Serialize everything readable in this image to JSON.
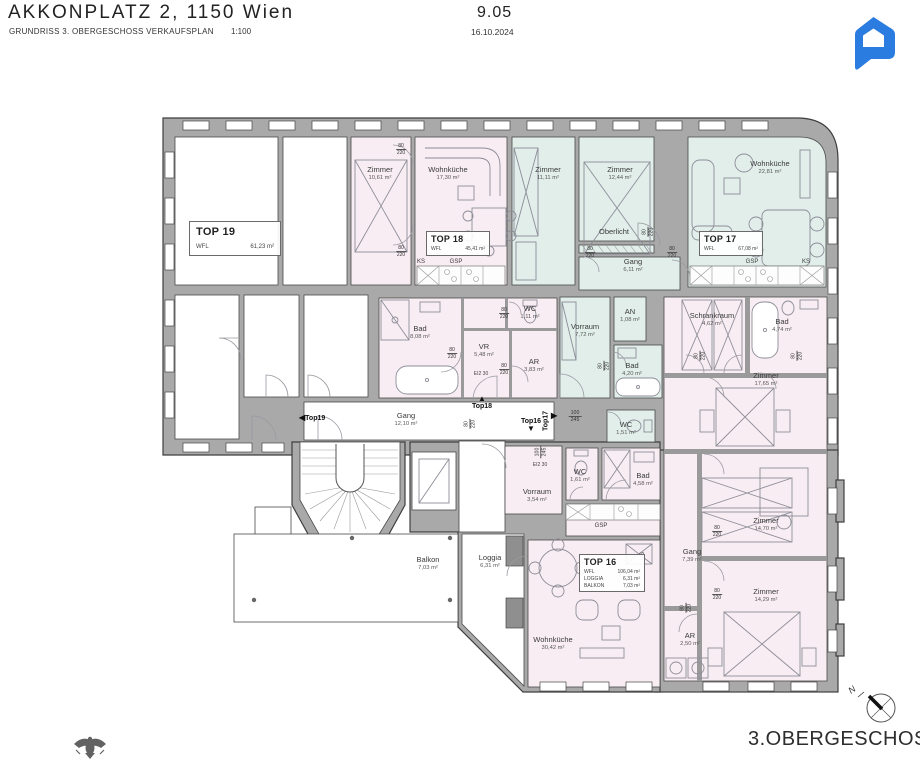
{
  "header": {
    "title": "AKKONPLATZ 2, 1150 Wien",
    "subtitle": "GRUNDRISS 3. OBERGESCHOSS VERKAUFSPLAN",
    "scale": "1:100",
    "sheet_number": "9.05",
    "date": "16.10.2024"
  },
  "colors": {
    "unit_pink": "#f8edf2",
    "unit_teal": "#e1eeea",
    "wall_gray": "#a9a9a9",
    "logo_blue": "#2b7ce0"
  },
  "units": {
    "top19": {
      "name": "TOP 19",
      "wfl_label": "WFL",
      "area": "61,23 m²"
    },
    "top18": {
      "name": "TOP 18",
      "wfl_label": "WFL",
      "area": "45,41 m²"
    },
    "top17": {
      "name": "TOP 17",
      "wfl_label": "WFL",
      "area": "67,08 m²"
    },
    "top16": {
      "name": "TOP 16",
      "rows": [
        {
          "label": "WFL",
          "value": "106,04 m²"
        },
        {
          "label": "LOGGIA",
          "value": "6,31 m²"
        },
        {
          "label": "BALKON",
          "value": "7,03 m²"
        }
      ]
    }
  },
  "rooms": [
    {
      "name": "Zimmer",
      "area": "10,61 m²"
    },
    {
      "name": "Wohnküche",
      "area": "17,30 m²"
    },
    {
      "name": "Zimmer",
      "area": "11,11 m²"
    },
    {
      "name": "Zimmer",
      "area": "12,44 m²"
    },
    {
      "name": "Wohnküche",
      "area": "22,81 m²"
    },
    {
      "name": "Oberlicht",
      "area": ""
    },
    {
      "name": "Gang",
      "area": "6,11 m²"
    },
    {
      "name": "Bad",
      "area": "8,08 m²"
    },
    {
      "name": "WC",
      "area": "1,11 m²"
    },
    {
      "name": "VR",
      "area": "5,48 m²"
    },
    {
      "name": "AR",
      "area": "3,83 m²"
    },
    {
      "name": "Vorraum",
      "area": "7,72 m²"
    },
    {
      "name": "AN",
      "area": "1,08 m²"
    },
    {
      "name": "Bad",
      "area": "4,20 m²"
    },
    {
      "name": "Schrankraum",
      "area": "4,62 m²"
    },
    {
      "name": "Bad",
      "area": "4,74 m²"
    },
    {
      "name": "Zimmer",
      "area": "17,65 m²"
    },
    {
      "name": "Gang",
      "area": "12,10 m²"
    },
    {
      "name": "WC",
      "area": "1,51 m²"
    },
    {
      "name": "WC",
      "area": "1,61 m²"
    },
    {
      "name": "Bad",
      "area": "4,58 m²"
    },
    {
      "name": "Vorraum",
      "area": "3,54 m²"
    },
    {
      "name": "Zimmer",
      "area": "14,70 m²"
    },
    {
      "name": "Gang",
      "area": "7,39 m²"
    },
    {
      "name": "Zimmer",
      "area": "14,29 m²"
    },
    {
      "name": "AR",
      "area": "2,50 m²"
    },
    {
      "name": "Wohnküche",
      "area": "30,42 m²"
    },
    {
      "name": "Balkon",
      "area": "7,03 m²"
    },
    {
      "name": "Loggia",
      "area": "6,31 m²"
    }
  ],
  "appliance_labels": {
    "ks": "KS",
    "gsp": "GSP"
  },
  "door_dim": {
    "w": "80",
    "h": "220"
  },
  "door_dim_large": {
    "w": "100",
    "h": "245"
  },
  "fire_label": "EI2 30",
  "markers": {
    "top19": "Top19",
    "top18": "Top18",
    "top17": "Top17",
    "top16": "Top16"
  },
  "footer": {
    "floor_label": "3.OBERGESCHOSS",
    "compass_label": "N"
  }
}
